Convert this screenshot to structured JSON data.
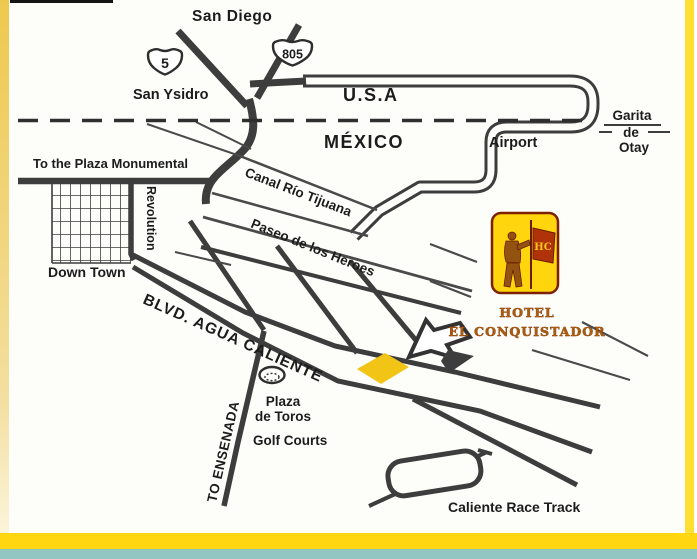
{
  "map": {
    "title_region": {
      "san_diego": "San Diego",
      "san_ysidro": "San Ysidro",
      "usa": "U.S.A",
      "mexico": "MÉXICO"
    },
    "shields": {
      "i5": "5",
      "i805": "805"
    },
    "border_crossing": {
      "garita_line1": "Garita",
      "garita_line2": "de",
      "garita_line3": "Otay"
    },
    "labels": {
      "airport": "Airport",
      "plaza_monumental": "To the Plaza Monumental",
      "revolution": "Revolution",
      "down_town": "Down Town",
      "canal": "Canal Río Tijuana",
      "paseo": "Paseo de los Heroes",
      "blvd_agua_caliente": "BLVD. AGUA CALIENTE",
      "to_ensenada": "TO ENSENADA",
      "plaza_toros_line1": "Plaza",
      "plaza_toros_line2": "de Toros",
      "golf_courts": "Golf Courts",
      "race_track": "Caliente Race Track"
    },
    "hotel": {
      "name_line1": "HOTEL",
      "name_line2": "EL CONQUISTADOR",
      "monogram": "HC"
    },
    "colors": {
      "road": "#3d3d3d",
      "text": "#1c1c1c",
      "marker_yellow": "#f2c415",
      "logo_yellow": "#ffd60d",
      "logo_border": "#7c2000",
      "logo_red": "#b03208",
      "hotel_text": "#a85d0e",
      "strip_left_top": "#eec94e",
      "strip_right": "#ffdf33",
      "strip_bottom_yellow": "#ffd60f",
      "strip_bottom_teal": "#91c6c3"
    }
  }
}
